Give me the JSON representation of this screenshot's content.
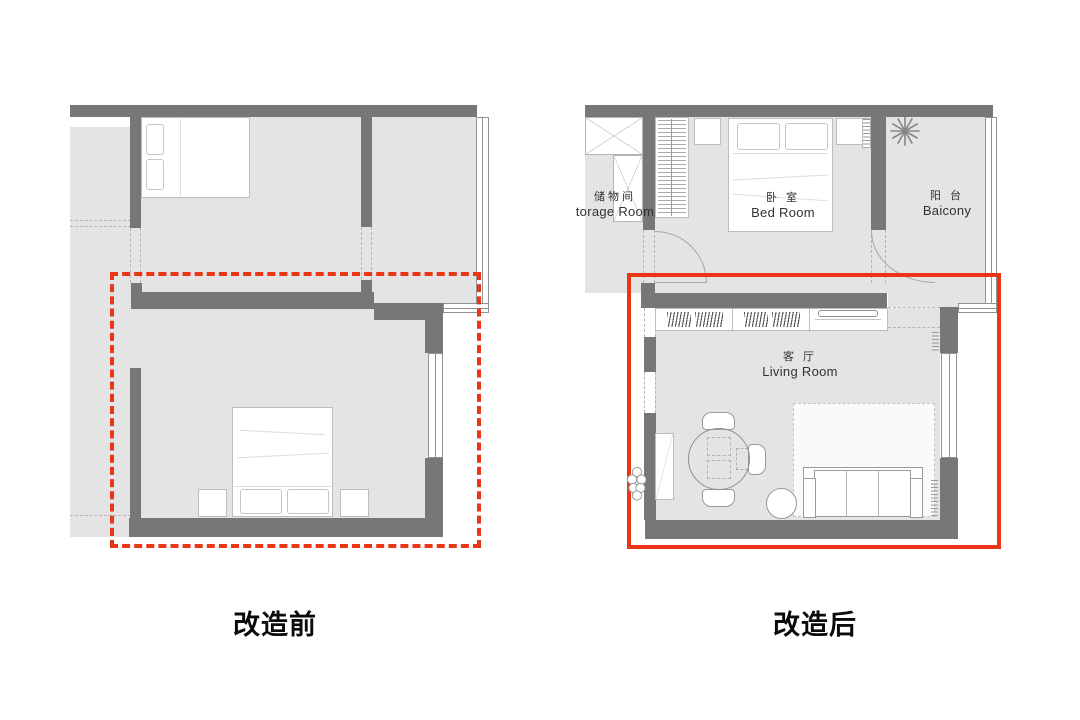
{
  "page": {
    "background": "#ffffff"
  },
  "colors": {
    "wall": "#777778",
    "floor": "#e4e4e4",
    "red": "#ea3517",
    "line": "#b5b5b5"
  },
  "before_plan": {
    "caption": "改造前",
    "highlight_style": "dashed-red-rectangle"
  },
  "after_plan": {
    "caption": "改造后",
    "highlight_style": "solid-red-rectangle",
    "rooms": {
      "storage": {
        "zh": "储物间",
        "en": "torage Room"
      },
      "bedroom": {
        "zh": "卧 室",
        "en": "Bed Room"
      },
      "balcony": {
        "zh": "阳 台",
        "en": "Baicony"
      },
      "living": {
        "zh": "客 厅",
        "en": "Living Room"
      }
    }
  },
  "icons": {
    "plant": "radial-leaf plant seen from above",
    "bush": "scalloped shrub outline"
  }
}
